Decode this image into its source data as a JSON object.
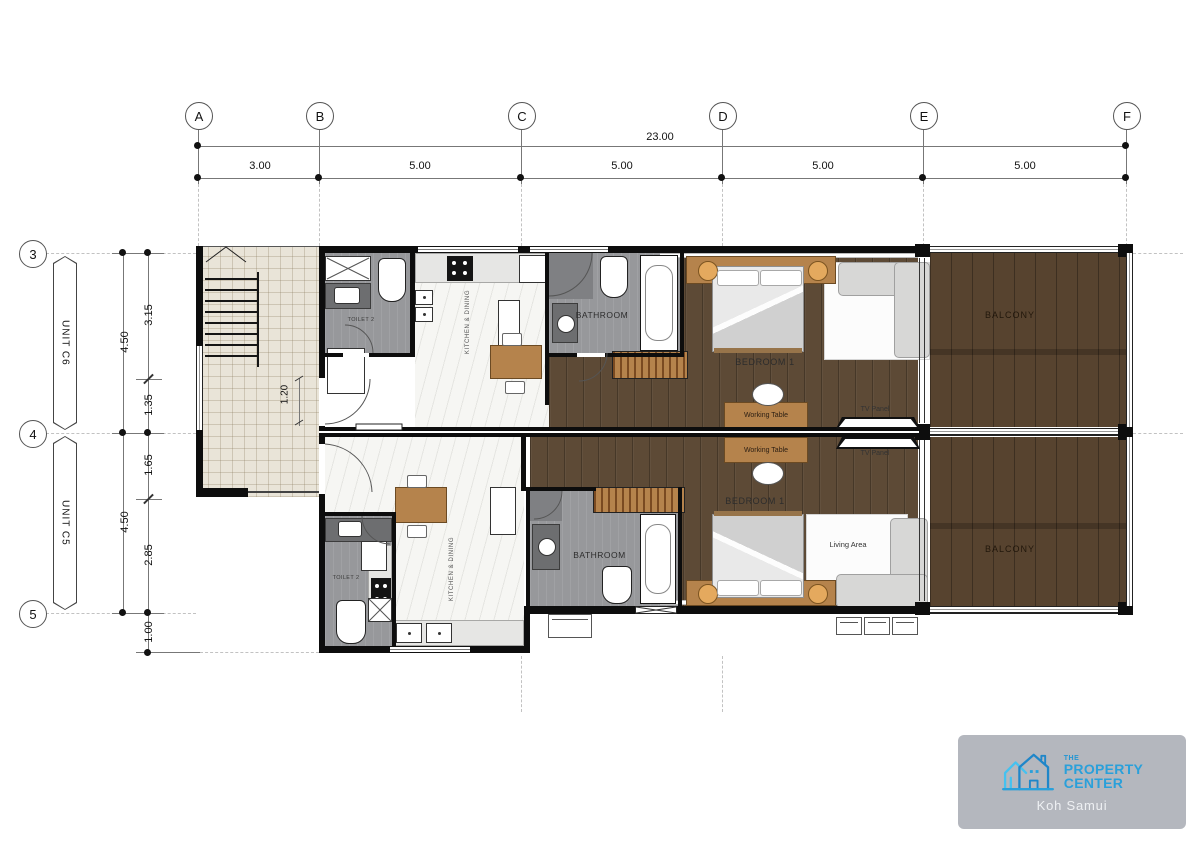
{
  "colors": {
    "wall": "#0d0d0d",
    "wood_floor": "#5d4a36",
    "deck": "#57432f",
    "tile": "#e9e4d8",
    "gray_room": "#97989b",
    "marble": "#f6f6f3",
    "furniture_wood": "#b5834c",
    "logo_blue": "#2aa0da",
    "logo_bg": "#b4b7be"
  },
  "grid": {
    "cols": [
      {
        "label": "A"
      },
      {
        "label": "B"
      },
      {
        "label": "C"
      },
      {
        "label": "D"
      },
      {
        "label": "E"
      },
      {
        "label": "F"
      }
    ],
    "rows": [
      {
        "label": "3"
      },
      {
        "label": "4"
      },
      {
        "label": "5"
      }
    ],
    "top": {
      "overall": "23.00",
      "segs": [
        "3.00",
        "5.00",
        "5.00",
        "5.00",
        "5.00"
      ]
    },
    "left": {
      "outer": [
        "4.50",
        "4.50"
      ],
      "inner": [
        "3.15",
        "1.35",
        "1.65",
        "2.85",
        "1.00"
      ]
    },
    "tags": [
      "UNIT C6",
      "UNIT C5"
    ]
  },
  "plan": {
    "c6": {
      "toilet": "TOILET 2",
      "kitchen": "KITCHEN & DINING",
      "bathroom": "BATHROOM",
      "bedroom": "BEDROOM 1",
      "working": "Working Table",
      "tv": "TV Panel",
      "balcony": "BALCONY",
      "entry_dim": "1.20"
    },
    "c5": {
      "toilet": "TOILET 2",
      "kitchen": "KITCHEN & DINING",
      "bathroom": "BATHROOM",
      "bedroom": "BEDROOM 1",
      "working": "Working Table",
      "tv": "TV Panel",
      "living": "Living Area",
      "balcony": "BALCONY"
    }
  },
  "logo": {
    "brand_the": "THE",
    "brand_property": "PROPERTY",
    "brand_center": "CENTER",
    "location": "Koh Samui"
  }
}
